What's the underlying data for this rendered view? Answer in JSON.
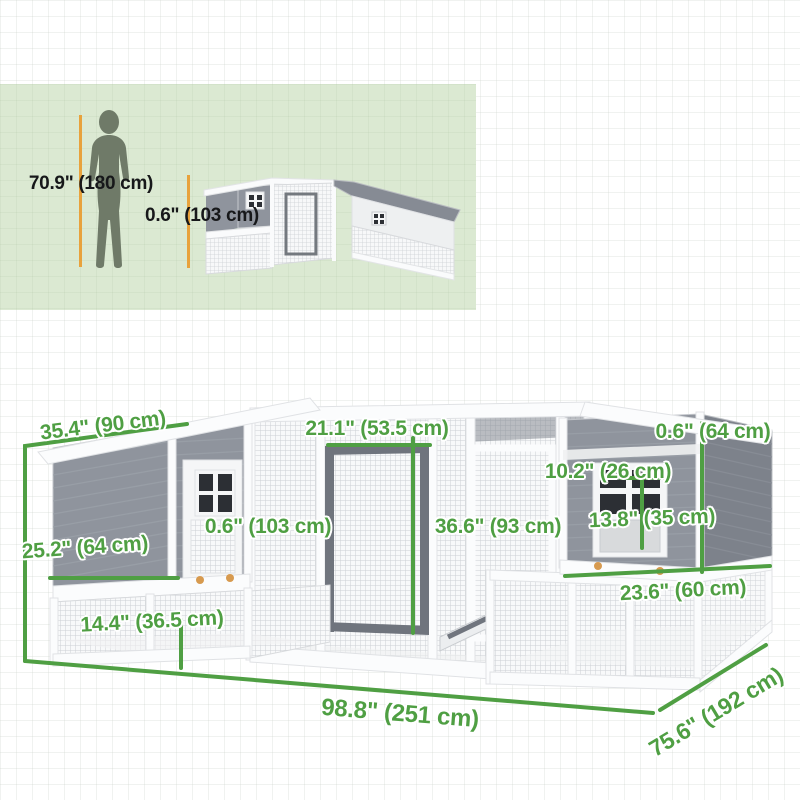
{
  "size_comparison": {
    "person_height_label": "70.9\" (180 cm)",
    "coop_height_label": "0.6\" (103 cm)"
  },
  "dimensions": {
    "roof_width": "35.4\" (90 cm)",
    "top_door_width": "21.1\" (53.5 cm)",
    "right_roof_height": "0.6\" (64 cm)",
    "window_width": "10.2\" (26 cm)",
    "window_height": "13.8\" (35 cm)",
    "left_door_height": "0.6\" (103 cm)",
    "run_height": "36.6\" (93 cm)",
    "left_height": "25.2\" (64 cm)",
    "left_run_depth": "14.4\" (36.5 cm)",
    "right_house_width": "23.6\" (60 cm)",
    "total_width": "98.8\" (251 cm)",
    "total_depth": "75.6\" (192 cm)"
  },
  "colors": {
    "dimension_green": "#4f9f43",
    "marker_yellow": "#e8a23c",
    "panel_background": "#dbe9d2",
    "coop_gray": "#8f949d",
    "coop_dark_gray": "#7d828b",
    "knob_orange": "#d79a4f",
    "silhouette": "#6f7a68"
  }
}
